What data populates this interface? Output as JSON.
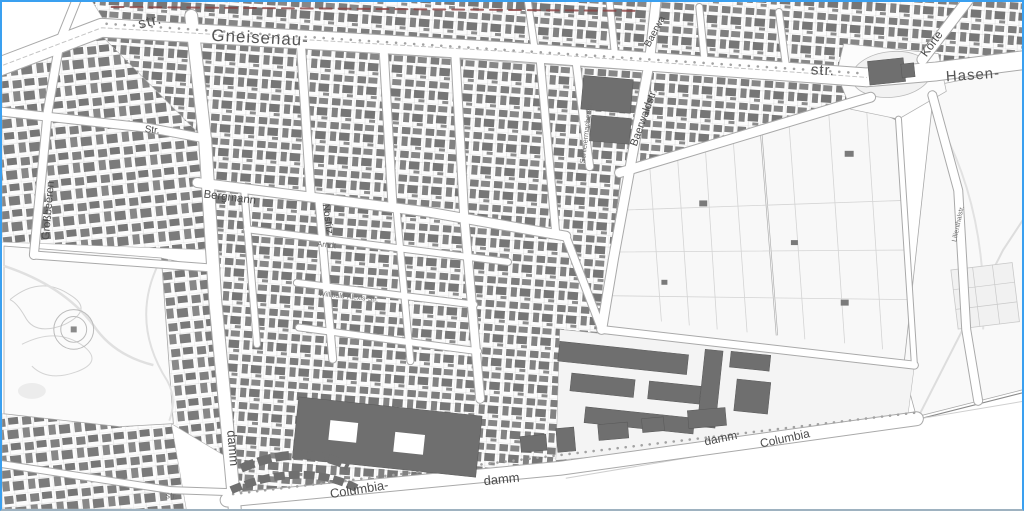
{
  "map": {
    "frame_color": "#3aa0f0",
    "building_color": "#7d7d7d",
    "street_color": "#ffffff",
    "labels": {
      "yorck_str": "str.",
      "gneisenau": "Gneisenau-",
      "mid_str": "str.",
      "hasen": "Hasen-",
      "koerte": "Körte",
      "grossbeeren": "Großbeeren",
      "left_str": "Str.",
      "bergmann": "Bergmann",
      "nostitz": "Nostitz",
      "arndt": "Arndt",
      "baerwald_top": "Baerwa",
      "baerwald": "Baerwaldstr.",
      "schleiermacher": "Schleiermacherstr.",
      "willibald_alexis": "Willibald-Alexis-Str.",
      "mehringdamm": "damm",
      "bottom_str": "str.",
      "columbia_w": "Columbia-",
      "damm_w": "damm",
      "damm_e": "damm",
      "columbia_e": "Columbia",
      "lilienthal": "Lilienthalstr."
    }
  }
}
